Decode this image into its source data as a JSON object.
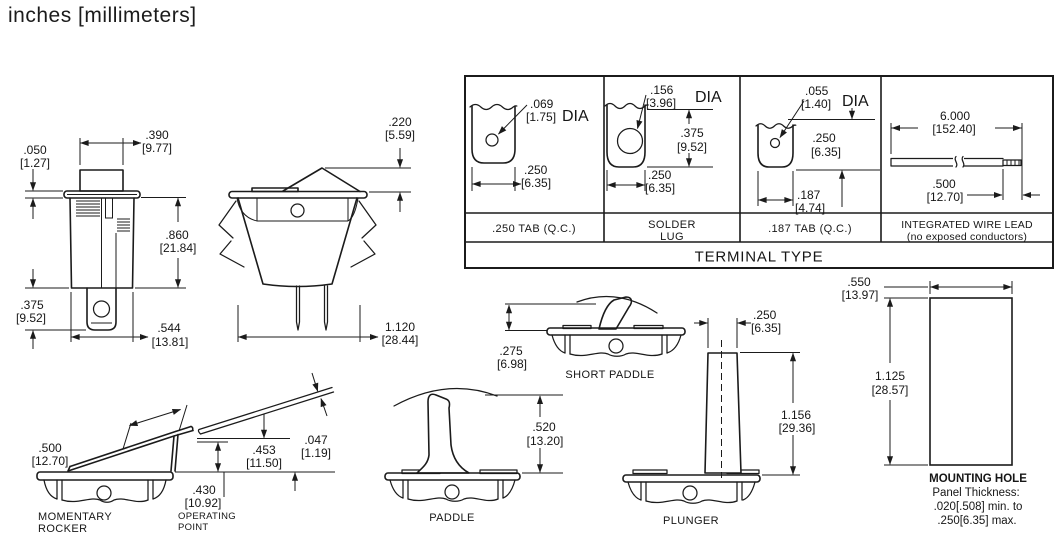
{
  "header": {
    "units": "inches [millimeters]"
  },
  "front_view": {
    "d050": {
      "in": ".050",
      "mm": "[1.27]"
    },
    "d390": {
      "in": ".390",
      "mm": "[9.77]"
    },
    "d860": {
      "in": ".860",
      "mm": "[21.84]"
    },
    "d375": {
      "in": ".375",
      "mm": "[9.52]"
    },
    "d544": {
      "in": ".544",
      "mm": "[13.81]"
    }
  },
  "side_view": {
    "d220": {
      "in": ".220",
      "mm": "[5.59]"
    },
    "d1120": {
      "in": "1.120",
      "mm": "[28.44]"
    }
  },
  "terminal_table": {
    "title": "TERMINAL TYPE",
    "tab250": {
      "label": ".250 TAB (Q.C.)",
      "dia_in": ".069",
      "dia_mm": "[1.75]",
      "dia_suffix": "DIA",
      "w_in": ".250",
      "w_mm": "[6.35]"
    },
    "solder_lug": {
      "label_line1": "SOLDER",
      "label_line2": "LUG",
      "dia_in": ".156",
      "dia_mm": "[3.96]",
      "dia_suffix": "DIA",
      "h_in": ".375",
      "h_mm": "[9.52]",
      "w_in": ".250",
      "w_mm": "[6.35]"
    },
    "tab187": {
      "label": ".187 TAB (Q.C.)",
      "dia_in": ".055",
      "dia_mm": "[1.40]",
      "dia_suffix": "DIA",
      "h_in": ".250",
      "h_mm": "[6.35]",
      "w_in": ".187",
      "w_mm": "[4.74]"
    },
    "wire_lead": {
      "label_line1": "INTEGRATED WIRE LEAD",
      "label_line2": "(no exposed conductors)",
      "len_in": "6.000",
      "len_mm": "[152.40]",
      "strip_in": ".500",
      "strip_mm": "[12.70]"
    }
  },
  "momentary_rocker": {
    "label_line1": "MOMENTARY",
    "label_line2": "ROCKER",
    "d500": {
      "in": ".500",
      "mm": "[12.70]"
    },
    "d453": {
      "in": ".453",
      "mm": "[11.50]"
    },
    "d047": {
      "in": ".047",
      "mm": "[1.19]"
    },
    "d430": {
      "in": ".430",
      "mm": "[10.92]"
    },
    "note_line1": "OPERATING",
    "note_line2": "POINT"
  },
  "short_paddle": {
    "label": "SHORT PADDLE",
    "d275": {
      "in": ".275",
      "mm": "[6.98]"
    }
  },
  "paddle": {
    "label": "PADDLE",
    "d520": {
      "in": ".520",
      "mm": "[13.20]"
    }
  },
  "plunger": {
    "label": "PLUNGER",
    "d250": {
      "in": ".250",
      "mm": "[6.35]"
    },
    "d1156": {
      "in": "1.156",
      "mm": "[29.36]"
    }
  },
  "mounting_hole": {
    "label": "MOUNTING HOLE",
    "d550": {
      "in": ".550",
      "mm": "[13.97]"
    },
    "d1125": {
      "in": "1.125",
      "mm": "[28.57]"
    },
    "note_line1": "Panel Thickness:",
    "note_line2": ".020[.508] min. to",
    "note_line3": ".250[6.35] max."
  },
  "colors": {
    "ink": "#1b1b1b",
    "background": "#ffffff"
  }
}
